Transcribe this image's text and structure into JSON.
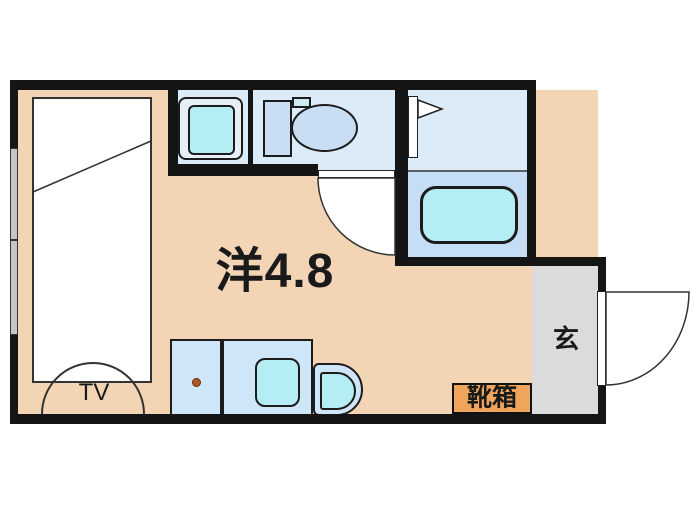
{
  "labels": {
    "main_room": "洋4.8",
    "entrance": "玄",
    "shoe_box": "靴箱",
    "tv": "TV"
  },
  "colors": {
    "wall": "#151515",
    "outline": "#1c1c1c",
    "floor-peach": "#f3d5b5",
    "wet-floor": "#dcebf8",
    "bath-lower": "#c5def5",
    "fixture-blue": "#cfe5f8",
    "fixture-cyan": "#b5edf4",
    "toilet-blue": "#c9def3",
    "genkan-gray": "#dbdbdd",
    "shoebox-orange": "#f0a55c"
  }
}
